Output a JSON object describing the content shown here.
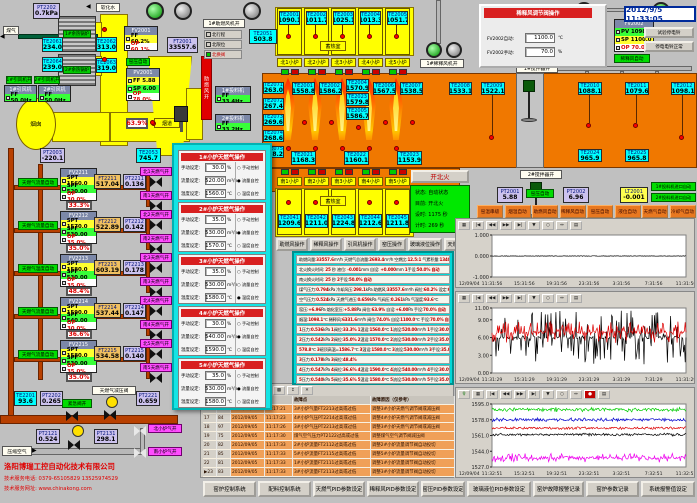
{
  "datetime": "2012/9/5 11:33:05",
  "company": {
    "name": "洛阳博瑞工控自动化技术有限公司",
    "line1": "技术服务电话: 0379-65105829  13525974529",
    "line2": "技术服务网址: www.chinakong.com"
  },
  "top_left": {
    "gas_label": "煤气",
    "soft_water_label": "软化水",
    "chimney_label": "烟囱",
    "flue_label": "烟道",
    "boiler1": "1#余热锅炉",
    "boiler2": "2#余热锅炉",
    "fan_open_labels": [
      "1#引风机开",
      "2#引风机开"
    ],
    "fan_boxes": [
      {
        "title": "1#引风机",
        "value": "FF 50.0Hz"
      },
      {
        "title": "2#引风机",
        "value": "FF 50.0Hz"
      }
    ],
    "feeder_boxes": [
      {
        "title": "1#投料机",
        "value": "FF 33.4Hz"
      },
      {
        "title": "2#投料机",
        "value": "FF 33.2Hz"
      }
    ],
    "values": {
      "PT2202": "0.7kPa",
      "TE2061": "234.0",
      "TE2064": "239.0",
      "TE2062": "313.0",
      "TE2063": "319.0",
      "PT2003": "-220.1",
      "TE2053": "745.7",
      "FT2001": "33557.6",
      "TE2051": "503.8"
    },
    "ctrl_fv2001": {
      "id": "FV2001",
      "rows": [
        [
          "FF",
          "60.2%",
          "y"
        ],
        [
          "OP",
          "60.1%",
          "w"
        ]
      ]
    },
    "ctrl_pv2001": {
      "id": "PV2001",
      "rows": [
        [
          "FF",
          "5.88",
          "y"
        ],
        [
          "SP",
          "6.00",
          "g"
        ],
        [
          "OP",
          "78.0%",
          "w"
        ]
      ]
    },
    "kiln_auto": "窑压自动",
    "damper_pos": "63.9%",
    "comb_fan_bar": "助燃风开",
    "comb_fan_open": "1#助燃风机开",
    "indicators": [
      {
        "label": "北行程",
        "on": false
      },
      {
        "label": "北限位",
        "on": false
      },
      {
        "label": "北换阀",
        "on": true
      }
    ]
  },
  "furnace": {
    "regen_label": "蓄热室",
    "north_regen": [
      {
        "id": "TE2001",
        "v": "1090.1"
      },
      {
        "id": "TE2002",
        "v": "1011.7"
      },
      {
        "id": "TE2003",
        "v": "1025.1"
      },
      {
        "id": "TE2004",
        "v": "1013.3"
      },
      {
        "id": "TE2005",
        "v": "1051.7"
      }
    ],
    "north_ports": [
      "北1小炉",
      "北2小炉",
      "北3小炉",
      "北4小炉",
      "北5小炉"
    ],
    "crown": [
      {
        "id": "TE2001",
        "v": "1558.8"
      },
      {
        "id": "TE2002",
        "v": "1586.2"
      },
      {
        "id": "TE2004",
        "v": "1570.9"
      },
      {
        "id": "TE2023",
        "v": "1579.8"
      },
      {
        "id": "TE2005",
        "v": "1586.7"
      },
      {
        "id": "TE2006",
        "v": "1567.5"
      },
      {
        "id": "TE2007",
        "v": "1538.5"
      },
      {
        "id": "TE2008",
        "v": "1533.1"
      }
    ],
    "left_col": [
      {
        "id": "TE2071",
        "v": "263.0"
      },
      {
        "id": "TE2072",
        "v": "267.4"
      },
      {
        "id": "TE2073",
        "v": "269.6"
      },
      {
        "id": "TE2074",
        "v": "268.6"
      },
      {
        "id": "TE2075",
        "v": "268.2"
      }
    ],
    "bottom": [
      {
        "id": "TE2021",
        "v": "1168.3"
      },
      {
        "id": "TE2022",
        "v": "1160.1"
      },
      {
        "id": "TE2023",
        "v": "1153.9"
      }
    ],
    "right": [
      {
        "id": "TE2009",
        "v": "1522.1"
      },
      {
        "id": "TE2010",
        "v": "1088.1"
      },
      {
        "id": "TE2011",
        "v": "1079.6"
      },
      {
        "id": "TE2012",
        "v": "1098.1"
      },
      {
        "id": "TE2024",
        "v": "965.9"
      },
      {
        "id": "TE2025",
        "v": "965.8"
      }
    ],
    "south_ports": [
      "南1小炉",
      "南2小炉",
      "南3小炉",
      "南4小炉",
      "南5小炉"
    ],
    "south_regen": [
      {
        "id": "TE2041",
        "v": "1209.6"
      },
      {
        "id": "TE2042",
        "v": "1211.0"
      },
      {
        "id": "TE2043",
        "v": "1224.8"
      },
      {
        "id": "TE2044",
        "v": "1212.6"
      },
      {
        "id": "TE2045",
        "v": "1211.8"
      }
    ],
    "stirrer1": "1#搅拌器开",
    "stirrer2": "2#搅拌器开",
    "dilution_fan1": "1#稀释风机开",
    "dilution_fan2": "2#稀释风机开"
  },
  "reversal": {
    "button": "开北火",
    "rows": [
      [
        "状态:",
        "自动状态"
      ],
      [
        "目前:",
        "开北火"
      ],
      [
        "设时:",
        "1175 秒"
      ],
      [
        "计时:",
        "269 秒"
      ]
    ]
  },
  "pressure": {
    "PT2001": "5.88",
    "auto": "窑压自动",
    "PT2002": "6.96",
    "LT2001": "-0.001",
    "feeders": [
      "1#投料机进口自动",
      "2#投料机进口自动"
    ]
  },
  "auto_buttons": [
    "窑温串级",
    "烟温自动",
    "助燃风自动",
    "稀释风自动",
    "窑压自动",
    "液位自动",
    "天燃气自动",
    "冷却气自动"
  ],
  "op_buttons": [
    "助燃风操作",
    "稀释风操作",
    "引风机操作",
    "窑压操作",
    "玻璃液位操作",
    "天燃气操作"
  ],
  "dilution_popup": {
    "title": "稀释风调节阀操作",
    "manual_btn": "FV2002手动",
    "auto_btn": "自动",
    "rows": [
      {
        "label": "FV2002自动:",
        "value": "1100.0",
        "unit": "℃"
      },
      {
        "label": "FV2002手动:",
        "value": "70.0",
        "unit": "%"
      }
    ],
    "ctrl": {
      "id": "FV2002",
      "rows": [
        [
          "PV",
          "1098.1",
          "g"
        ],
        [
          "SP",
          "1100.0",
          "y"
        ],
        [
          "OP",
          "70.0%",
          "w"
        ]
      ]
    },
    "auto_label": "稀释风自动",
    "pos": "74.0%",
    "ft": {
      "id": "FT2002",
      "v": "6331.6"
    },
    "bell_buttons": [
      "试验停电铃",
      "停电电铃正常"
    ]
  },
  "gas_trains": [
    {
      "auto": "天燃气流量自动",
      "ctrl": "FV2211",
      "spt": "1560.0",
      "spf": "520.00",
      "op": "30.0%",
      "pos": "33.3%",
      "ft_id": "FT2211",
      "ft": "517.04",
      "pt_id": "PT2211",
      "pt": "0.136",
      "north": "北1天燃气开",
      "south": "南1天燃气开"
    },
    {
      "auto": "天燃气流量自动",
      "ctrl": "FV2212",
      "spt": "1570.0",
      "spf": "530.00",
      "op": "35.0%",
      "pos": "35.0%",
      "ft_id": "FT2212",
      "ft": "522.89",
      "pt_id": "PT2212",
      "pt": "0.142",
      "north": "北2天燃气开",
      "south": "南2天燃气开"
    },
    {
      "auto": "天燃气温度自动",
      "ctrl": "FV2213",
      "spt": "1580.0",
      "spf": "530.00",
      "op": "35.0%",
      "pos": "48.4%",
      "ft_id": "FT2213",
      "ft": "603.19",
      "pt_id": "PT2213",
      "pt": "0.178",
      "north": "北3天燃气开",
      "south": "南3天燃气开"
    },
    {
      "auto": "天燃气流量自动",
      "ctrl": "FV2214",
      "spt": "1590.0",
      "spf": "540.00",
      "op": "30.0%",
      "pos": "36.6%",
      "ft_id": "FT2214",
      "ft": "537.44",
      "pt_id": "PT2214",
      "pt": "0.147",
      "north": "北4天燃气开",
      "south": "南4天燃气开"
    },
    {
      "auto": "天燃气流量自动",
      "ctrl": "FV2215",
      "spt": "1580.0",
      "spf": "530.00",
      "op": "35.0%",
      "pos": "35.0%",
      "ft_id": "FT2215",
      "ft": "534.58",
      "pt_id": "PT2215",
      "pt": "0.140",
      "north": "北5天燃气开",
      "south": "南5天燃气开"
    }
  ],
  "bottom_left": {
    "TE2201": "93.6",
    "PT2202": "0.265",
    "emerg": "紧急阀开",
    "reducer": "天燃气减压阀",
    "PT2221": "0.659",
    "PT2121": "0.524",
    "PT2131": "298.1",
    "air_label": "压缩空气",
    "north_air": "北小炉气开",
    "south_air": "南小炉气开"
  },
  "furnace_popup": {
    "field_labels": [
      "手动设定:",
      "流量设定:",
      "温度设定:"
    ],
    "units": [
      "%",
      "m³/h",
      "℃"
    ],
    "modes": [
      "手动控制",
      "流量自控",
      "温度自控"
    ],
    "panels": [
      {
        "title": "1#小炉天燃气操作",
        "manual": "30.0",
        "flow": "520.00",
        "temp": "1560.0",
        "mode": 1
      },
      {
        "title": "2#小炉天燃气操作",
        "manual": "35.0",
        "flow": "530.00",
        "temp": "1570.0",
        "mode": 1
      },
      {
        "title": "3#小炉天燃气操作",
        "manual": "35.0",
        "flow": "530.00",
        "temp": "1580.0",
        "mode": 2
      },
      {
        "title": "4#小炉天燃气操作",
        "manual": "30.0",
        "flow": "540.00",
        "temp": "1590.0",
        "mode": 1
      },
      {
        "title": "5#小炉天燃气操作",
        "manual": "35.0",
        "flow": "530.00",
        "temp": "1580.0",
        "mode": 1
      }
    ]
  },
  "info_panel": {
    "rows": [
      "助燃风量:33557.6m³/h 天燃气总流量:2693.4m³/h 空燃比:12.5:1 气累积量:134057.7m³",
      "北火换火时间: 25 秒  液位: -0.001mm 自设: +0.000mm  1手设:50.0% 自动",
      "南火换火时间: 25 秒                2手设:50.0% 自动",
      "煤气压力:0.794kPa 冷却风压:298.1kPa 助燃风:33557.6m³/h 阀位:60.2% 设定:60.0%",
      "空气压力:0.524kPa 天燃气进压:0.659kPa 气阀压:0.261kPa 气温度:93.6℃",
      "窑压:+6.96Pa 熔化室压:+5.88Pa 阀位:63.9% 自设:+6.00Pa 手设:70.0% 自动",
      "烟温:1098.1℃ 稀释风:6331.6m³/h 阀位:74.0% 自设:1100.0℃ 手设:70.0% 自动",
      "1压力:0.536kPa 1阀位:33.3% 1温设:1560.0℃ 1流设:520.00m³/h 1手设:30.0% 流控",
      "2压力:0.542kPa 2阀位:35.0% 2温设:1570.0℃ 2流设:530.00m³/h 2手设:35.0% 流控",
      "578.8℃ 3碹顶高温=1586.7℃ 3温设:1580.0℃ 3流设:530.00m³/h 3手设:35.0% 温控",
      "3压力:0.178kPa 3阀位:48.4%",
      "4压力:0.547kPa 4阀位:36.6% 4温设:1590.0℃ 4流设:540.00m³/h 4手设:30.0% 流控",
      "5压力:0.540kPa 5阀位:35.6% 5温设:1580.0℃ 5流设:530.00m³/h 5手设:35.0% 流控"
    ]
  },
  "alarm_table": {
    "headers": [
      "故障点",
      "故障原因（仅参考）"
    ],
    "rows": [
      [
        "16",
        "98",
        "2012/09/05",
        "11:17:21",
        "3#小炉气量FT2213过高或过低",
        "调整3#小炉天燃气调节阀或减压阀"
      ],
      [
        "17",
        "84",
        "2012/09/05",
        "11:17:23",
        "4#小炉气压PT2214过高或过低",
        "调整4#小炉天燃气调节阀或减压阀"
      ],
      [
        "18",
        "97",
        "2012/09/05",
        "11:17:26",
        "3#小炉气压PT2213过高或过低",
        "调整3#小炉天燃气调节阀或减压阀"
      ],
      [
        "19",
        "75",
        "2012/09/05",
        "11:17:30",
        "煤气空气压力PT2122过高或过低",
        "调整煤气空气调节阀减压阀"
      ],
      [
        "20",
        "82",
        "2012/09/05",
        "11:17:33",
        "2#小炉流量FT2112过高或过低",
        "调整2#小炉流量调节阀自动投切"
      ],
      [
        "21",
        "85",
        "2012/09/05",
        "11:17:33",
        "5#小炉流量FT2115过高或过低",
        "调整5#小炉流量调节阀自动投切"
      ],
      [
        "22",
        "81",
        "2012/09/05",
        "11:17:33",
        "1#小炉流量FT2111过高或过低",
        "调整1#小炉流量调节阀自动投切"
      ],
      [
        "23",
        "83",
        "2012/09/05",
        "11:17:33",
        "3#小炉流量FT2113过高或过低",
        "调整3#小炉流量调节阀自动投切"
      ]
    ],
    "selected_row": "23",
    "toolbar": [
      "print",
      "list",
      "help",
      "cells",
      "grid",
      "filter",
      "sort",
      "cut"
    ]
  },
  "bottom_buttons": [
    "窑炉控制系统",
    "配料控制系统",
    "天燃气PID参数设定",
    "稀释风PID参数设定",
    "窑压PID参数设定",
    "玻璃液位PID参数设定",
    "窑炉故障报警记录",
    "窑炉参数记录",
    "系统报警值设定"
  ],
  "chart_data": [
    {
      "type": "line",
      "title": "窑压趋势",
      "yticks": [
        "1.000",
        "0.000",
        "-1.000"
      ],
      "ylim": [
        -1,
        1
      ],
      "date_label": "12/09/04",
      "xticks": [
        "11:31:56",
        "15:31:56",
        "19:31:56",
        "23:31:56",
        "3:31:56",
        "7:31:56",
        "11:31:56"
      ],
      "toolbar": [
        "grid",
        "first",
        "prev",
        "next",
        "last",
        "pen",
        "zoom",
        "fit",
        "export"
      ],
      "series": [
        {
          "name": "玻璃液位",
          "color": "#000000",
          "base": 0,
          "noise": 0.012,
          "spike": 0,
          "spike_p": 0
        }
      ]
    },
    {
      "type": "line",
      "title": "窑压/熔化室压趋势",
      "yticks": [
        "11.00",
        "9.00",
        "6.00",
        "3.00",
        "0.00"
      ],
      "ylim": [
        0,
        11
      ],
      "date_label": "12/09/04",
      "xticks": [
        "11:31:29",
        "15:31:29",
        "19:31:29",
        "23:31:29",
        "3:31:29",
        "7:31:29",
        "11:31:29"
      ],
      "toolbar": [
        "grid",
        "first",
        "prev",
        "next",
        "last",
        "pen",
        "zoom",
        "fit",
        "export"
      ],
      "series": [
        {
          "name": "窑压",
          "color": "#000000",
          "base": 6.0,
          "noise": 0.2,
          "spike": 4.6,
          "spike_p": 0.45
        },
        {
          "name": "熔化室压",
          "color": "#dd0000",
          "base": 6.9,
          "noise": 0.25,
          "spike": 1.8,
          "spike_p": 0.5
        }
      ]
    },
    {
      "type": "line",
      "title": "小炉温度趋势",
      "yticks": [
        "1595.0",
        "1578.0",
        "1561.0",
        "1544.0",
        "1527.0"
      ],
      "ylim": [
        1527,
        1595
      ],
      "date_label": "12/09/04",
      "xticks": [
        "11:32:51",
        "15:32:51",
        "19:32:51",
        "23:32:51",
        "3:32:51",
        "7:32:51",
        "11:32:51"
      ],
      "toolbar": [
        "key",
        "grid",
        "first",
        "prev",
        "next",
        "last",
        "pen",
        "zoom",
        "fit",
        "stop",
        "export"
      ],
      "series": [
        {
          "name": "5#小炉",
          "color": "#00cc00",
          "base": 1589,
          "noise": 1.5,
          "spike": 2.5,
          "spike_p": 0.3
        },
        {
          "name": "4#小炉",
          "color": "#0000cc",
          "base": 1578,
          "noise": 1.2,
          "spike": 2.0,
          "spike_p": 0.3
        },
        {
          "name": "2#小炉",
          "color": "#dd0000",
          "base": 1569,
          "noise": 1.0,
          "spike": 1.5,
          "spike_p": 0.3
        },
        {
          "name": "1#小炉",
          "color": "#000000",
          "base": 1562,
          "noise": 1.0,
          "spike": 1.5,
          "spike_p": 0.3
        },
        {
          "name": "3#小炉",
          "color": "#ee00ee",
          "base": 1537,
          "noise": 1.5,
          "spike": 5.0,
          "spike_p": 0.4
        }
      ]
    }
  ]
}
